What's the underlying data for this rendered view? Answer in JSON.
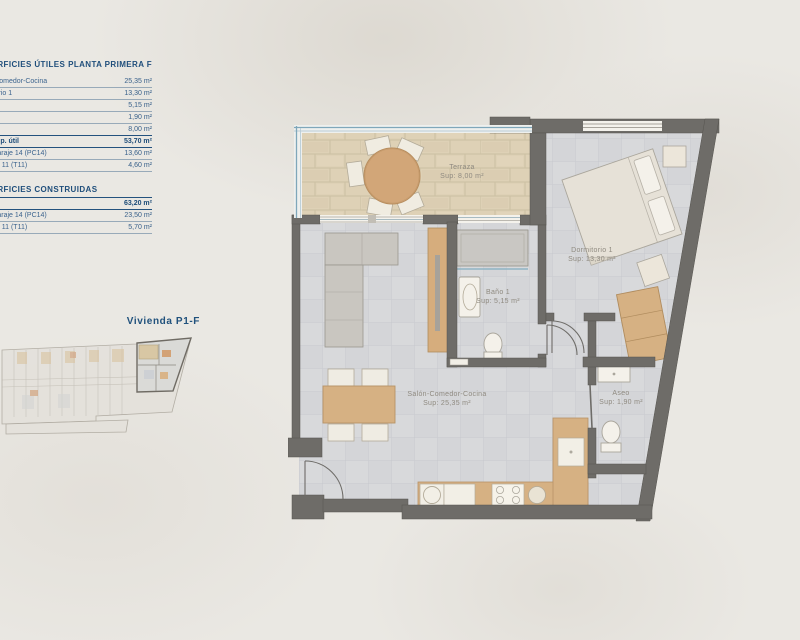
{
  "background": {
    "color": "#eae8e3"
  },
  "colors": {
    "accent_blue": "#1f4e7b",
    "wall_gray": "#6e6c68",
    "wood_tan": "#d6b183",
    "terrace_tile": "#ded1b6",
    "interior_tile": "#d8d9db",
    "glass_blue": "#7fa7ba"
  },
  "spec_table": {
    "header_left": "SUPERFICIES ÚTILES",
    "header_right": "PLANTA PRIMERA F",
    "useful_rows": [
      {
        "label": "Salón-Comedor-Cocina",
        "value": "25,35 m²",
        "bold": false
      },
      {
        "label": "Dormitorio 1",
        "value": "13,30 m²",
        "bold": false
      },
      {
        "label": "Baño 1",
        "value": "5,15 m²",
        "bold": false
      },
      {
        "label": "Aseo",
        "value": "1,90 m²",
        "bold": false
      },
      {
        "label": "Terraza",
        "value": "8,00 m²",
        "bold": false
      },
      {
        "label": "Total sup. útil",
        "value": "53,70 m²",
        "bold": true
      },
      {
        "label": "Plaza garaje 14 (PC14)",
        "value": "13,60 m²",
        "bold": false
      },
      {
        "label": "Trastero 11 (T11)",
        "value": "4,60 m²",
        "bold": false
      }
    ],
    "built_header": "SUPERFICIES CONSTRUIDAS",
    "built_rows": [
      {
        "label": "",
        "value": "63,20 m²",
        "bold": true
      },
      {
        "label": "Plaza garaje 14 (PC14)",
        "value": "23,50 m²",
        "bold": false
      },
      {
        "label": "Trastero 11 (T11)",
        "value": "5,70 m²",
        "bold": false
      }
    ]
  },
  "mini_plan": {
    "label": "Vivienda P1-F"
  },
  "floor_plan": {
    "rooms": [
      {
        "name": "Terraza",
        "area": "Sup: 8,00 m²"
      },
      {
        "name": "Dormitorio 1",
        "area": "Sup: 13,30 m²"
      },
      {
        "name": "Baño 1",
        "area": "Sup: 5,15 m²"
      },
      {
        "name": "Salón-Comedor-Cocina",
        "area": "Sup: 25,35 m²"
      },
      {
        "name": "Aseo",
        "area": "Sup: 1,90 m²"
      }
    ]
  }
}
